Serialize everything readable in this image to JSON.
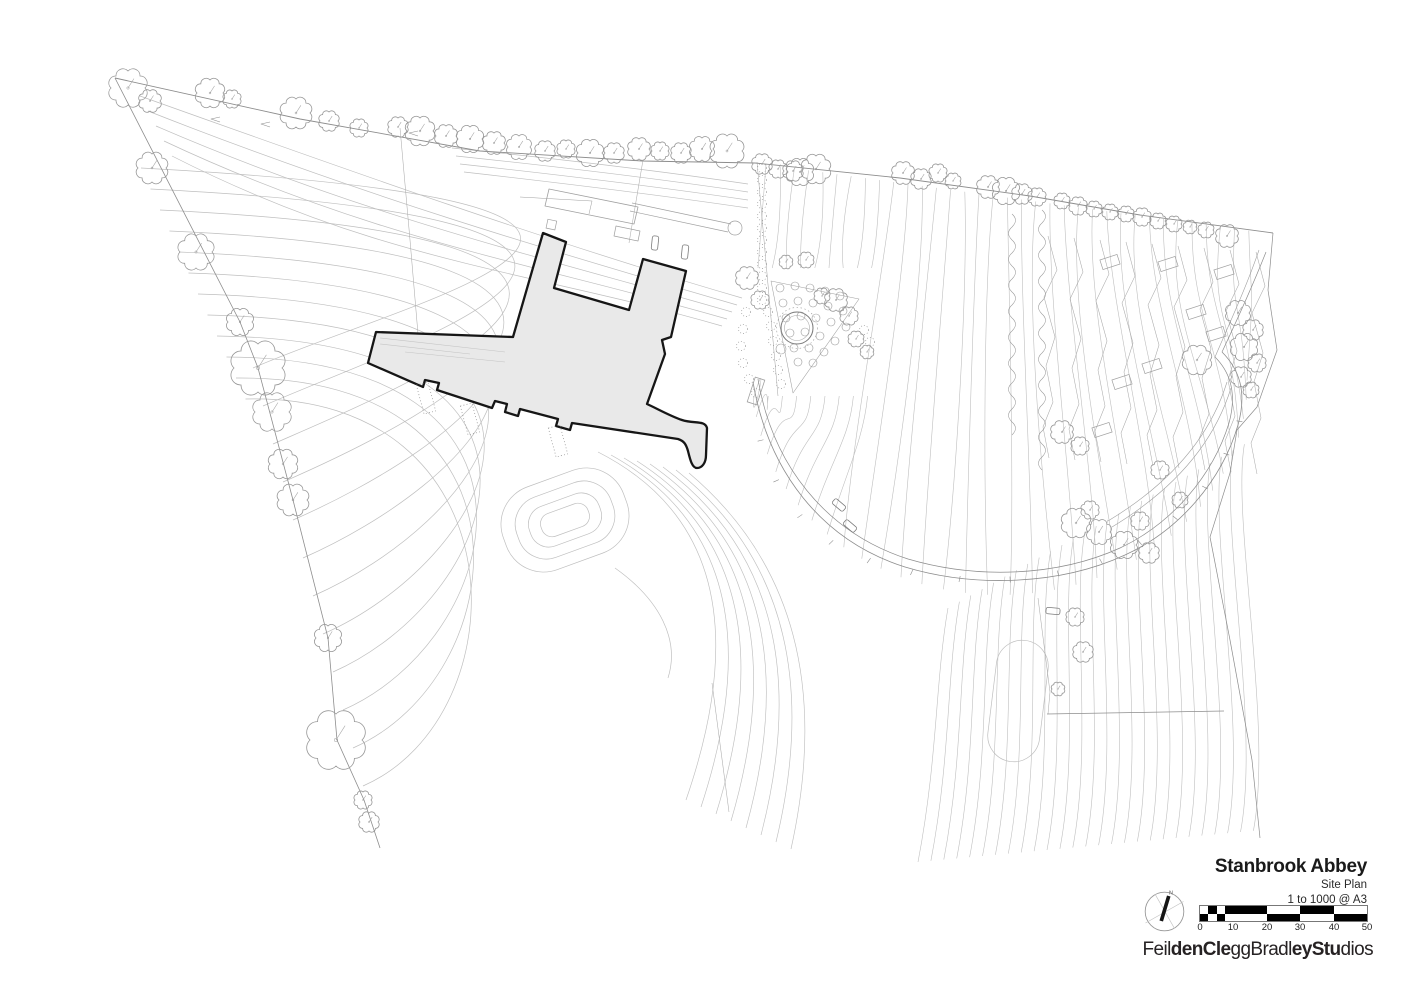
{
  "title_block": {
    "project": "Stanbrook Abbey",
    "drawing": "Site Plan",
    "scale": "1 to 1000 @ A3"
  },
  "north_arrow": {
    "label": "N"
  },
  "scale_bar": {
    "unit_labels": [
      "0",
      "10",
      "20",
      "30",
      "40",
      "50"
    ]
  },
  "logo": {
    "segments": [
      {
        "text": "Feil",
        "bold": false
      },
      {
        "text": "denCle",
        "bold": true
      },
      {
        "text": "ggBradl",
        "bold": false
      },
      {
        "text": "eyStu",
        "bold": true
      },
      {
        "text": "dios",
        "bold": false
      }
    ]
  },
  "colors": {
    "paper": "#ffffff",
    "building_fill": "#e9e9e9",
    "contour_line": "#bdbdbd",
    "ink": "#1a1a1a"
  }
}
